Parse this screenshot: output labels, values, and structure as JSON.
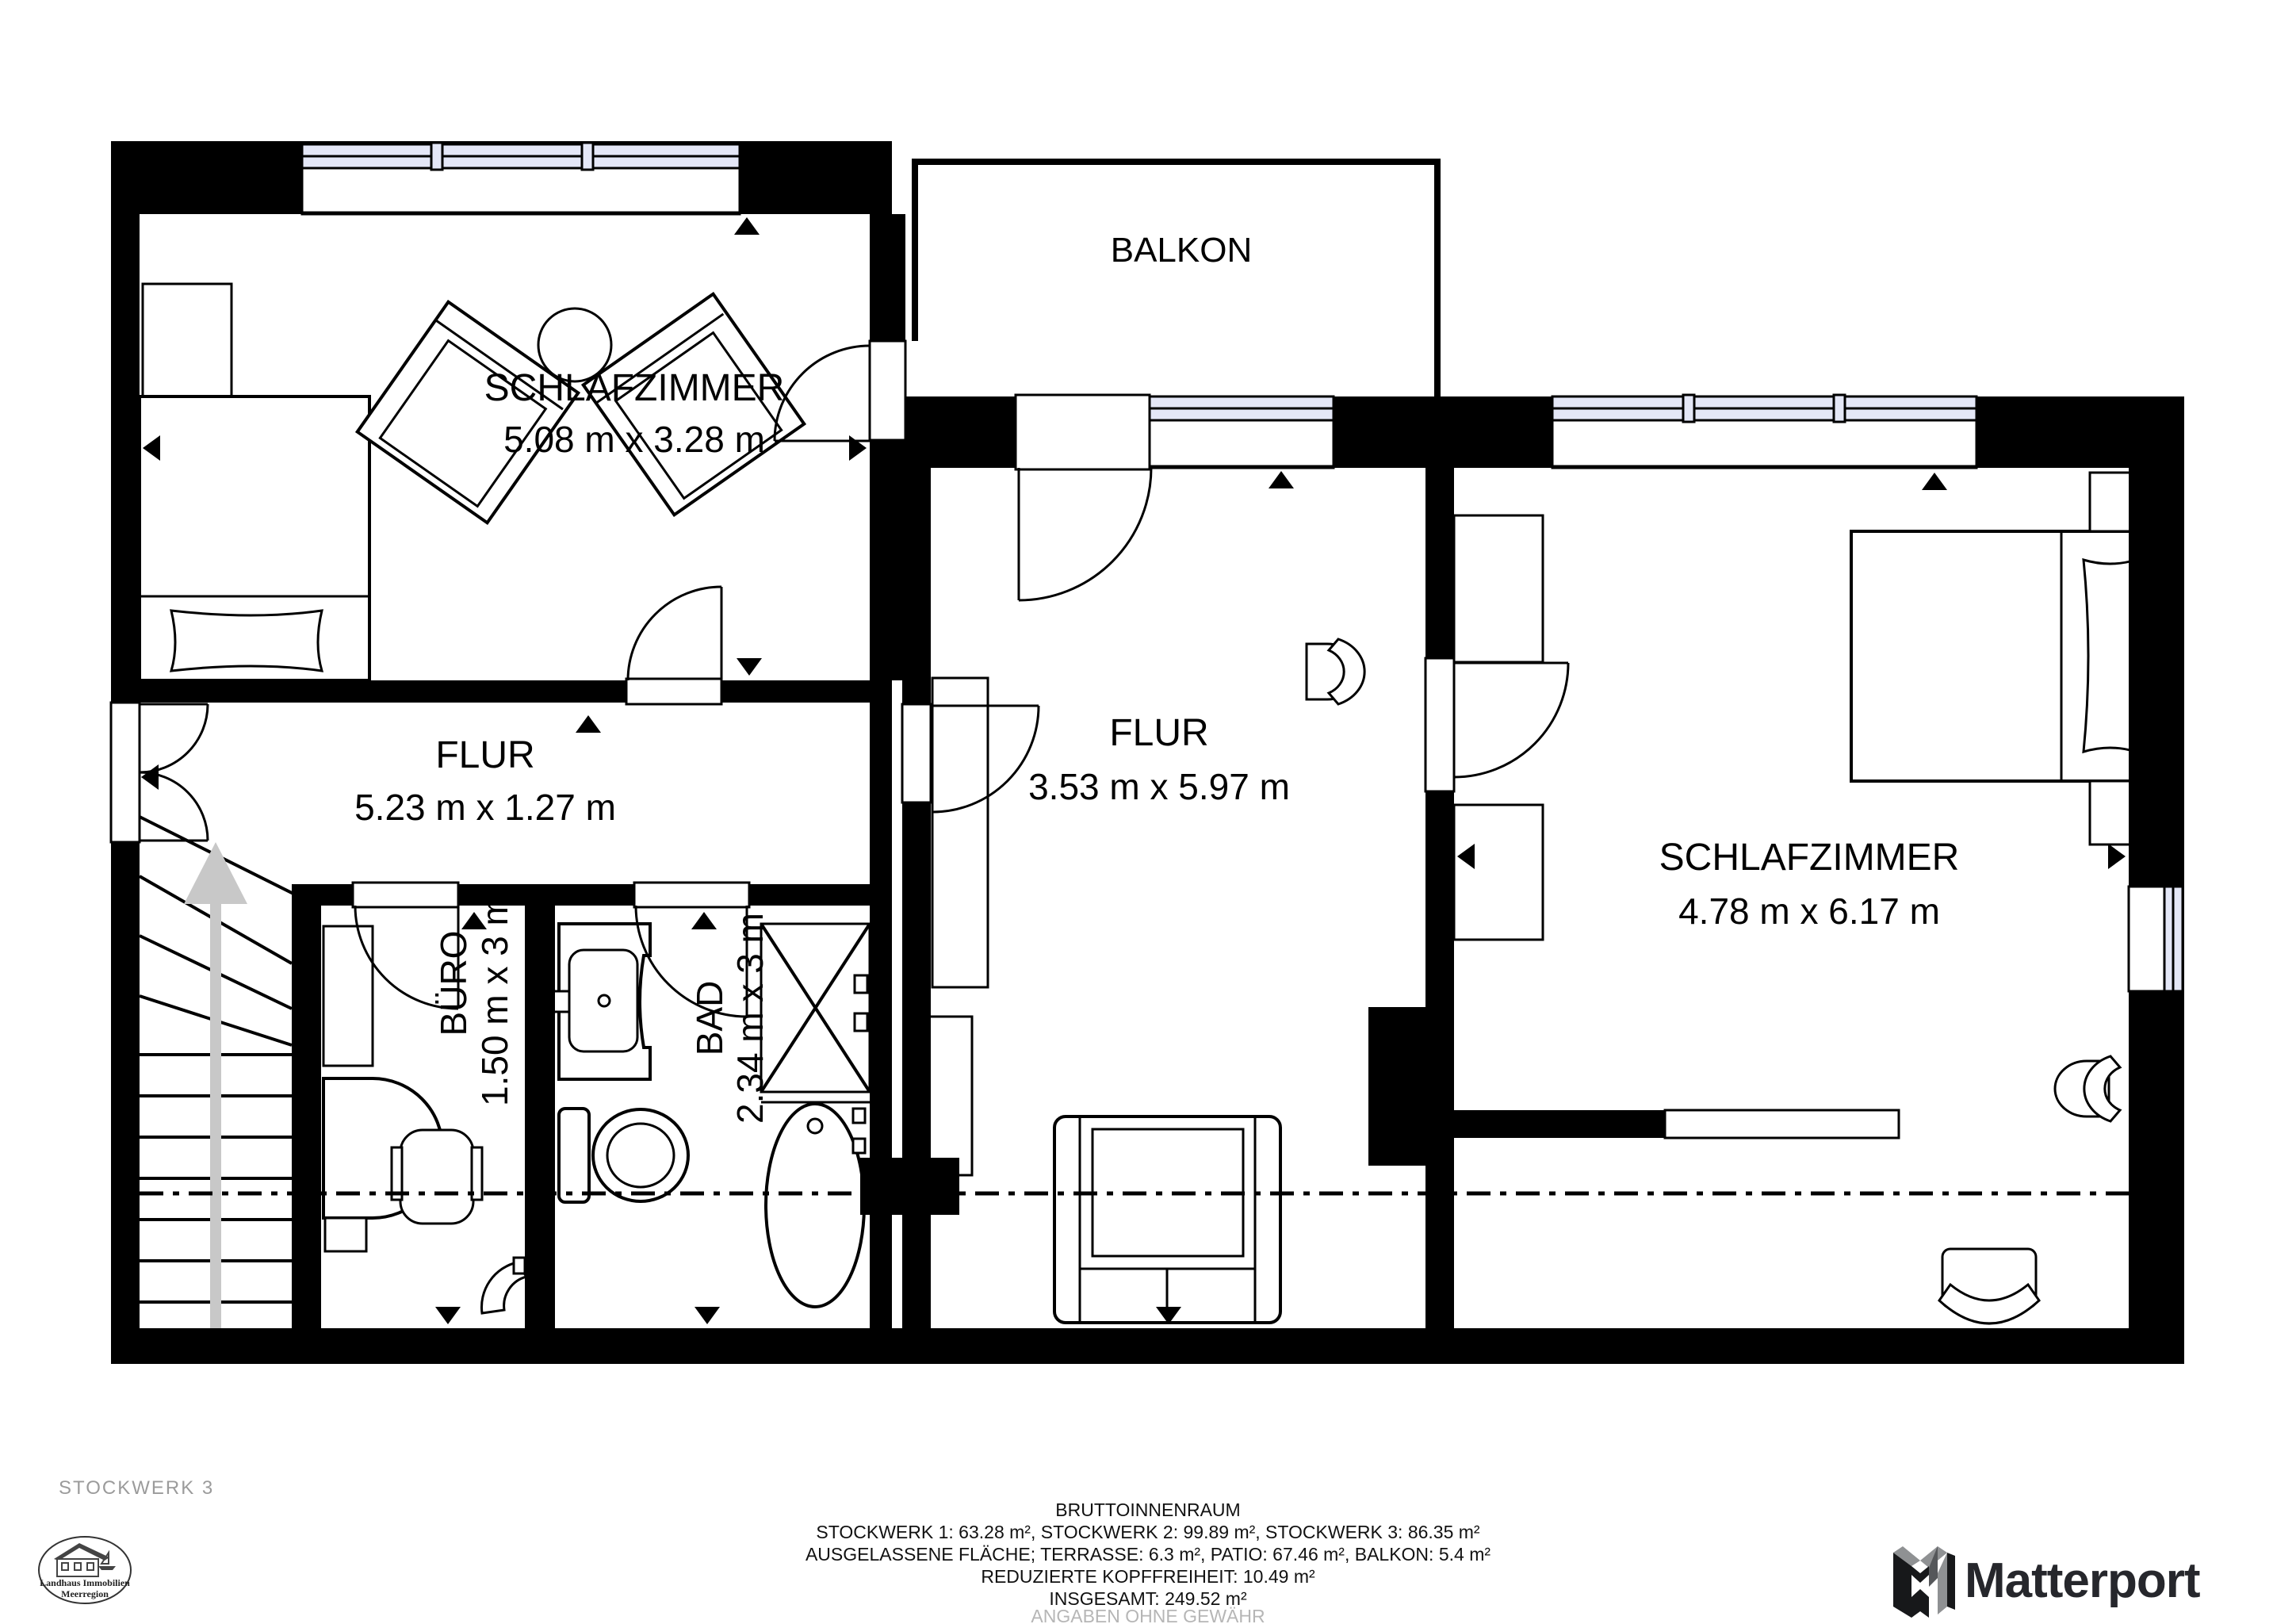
{
  "floor": {
    "label": "STOCKWERK 3"
  },
  "rooms": {
    "bedroom_left": {
      "name": "SCHLAFZIMMER",
      "dims": "5.08 m x 3.28 m"
    },
    "balcony": {
      "name": "BALKON"
    },
    "hall_middle": {
      "name": "FLUR",
      "dims": "3.53 m x 5.97 m"
    },
    "hall_corridor": {
      "name": "FLUR",
      "dims": "5.23 m x 1.27 m"
    },
    "office": {
      "name": "BÜRO",
      "dims": "1.50 m x 3 m"
    },
    "bath": {
      "name": "BAD",
      "dims": "2.34 m x 3 m"
    },
    "bedroom_right": {
      "name": "SCHLAFZIMMER",
      "dims": "4.78 m x 6.17 m"
    }
  },
  "footer": {
    "title": "BRUTTOINNENRAUM",
    "areas_line": "STOCKWERK 1: 63.28 m², STOCKWERK 2: 99.89 m², STOCKWERK 3: 86.35 m²",
    "excluded_line": "AUSGELASSENE FLÄCHE; TERRASSE: 6.3 m², PATIO: 67.46 m², BALKON: 5.4 m²",
    "reduced_line": "REDUZIERTE KOPFFREIHEIT: 10.49 m²",
    "total_line": "INSGESAMT: 249.52 m²",
    "disclaimer": "ANGABEN OHNE GEWÄHR"
  },
  "agency": {
    "line1": "Landhaus Immobilien",
    "line2": "Meerregion"
  },
  "branding": {
    "wordmark": "Matterport"
  },
  "colors": {
    "wall": "#000000",
    "window_glass": "#e4e7f7",
    "muted_text": "#9b9b9b",
    "stairs_arrow": "#c8c8c8",
    "brand_dark": "#26272c"
  }
}
